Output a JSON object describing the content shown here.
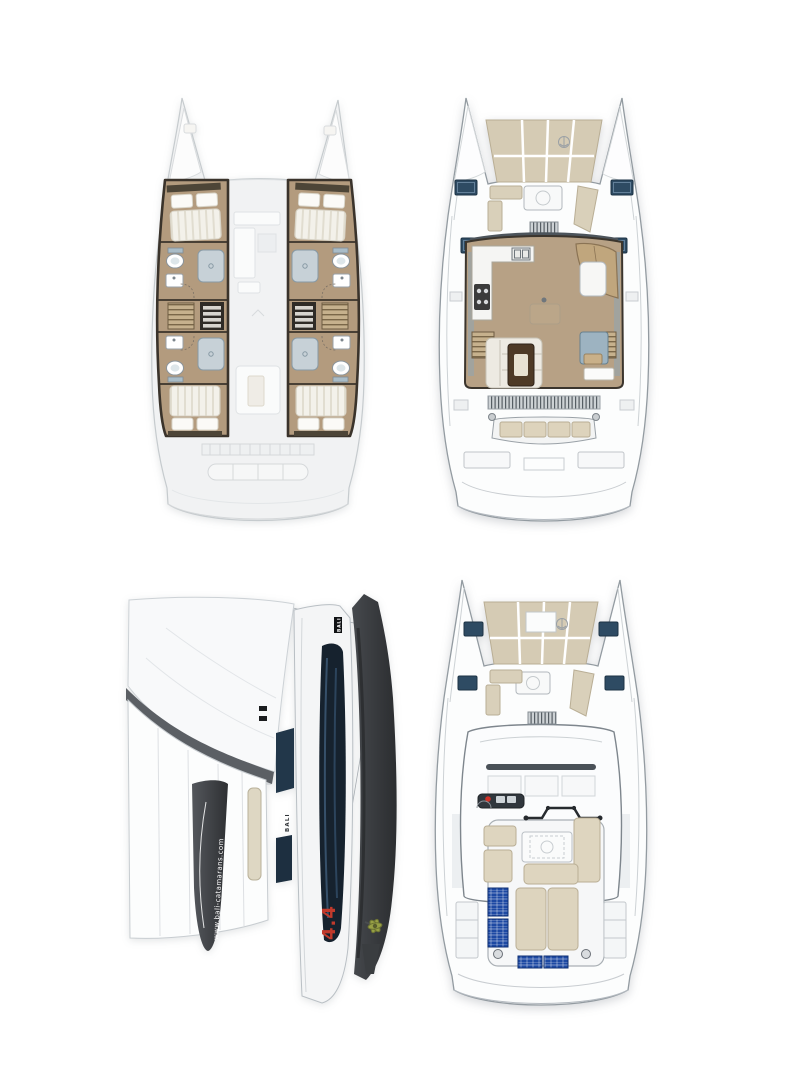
{
  "branding": {
    "brand": "BALI",
    "model": "4.4",
    "website": "www.bali-catamarans.com",
    "bow_chip_label": "BALI",
    "hull_side_label": "BALI"
  },
  "views": {
    "lower_deck_plan": {
      "position": "top-left",
      "cabins": 4,
      "bathrooms": 4
    },
    "main_deck_plan": {
      "position": "top-right",
      "deck_hatches": 4
    },
    "side_profile": {
      "position": "bottom-left"
    },
    "flybridge_plan": {
      "position": "bottom-right",
      "solar_panels": 4,
      "sunpads": 2,
      "deck_hatches": 4
    }
  },
  "colors": {
    "background": "#ffffff",
    "wood_floor": "#b39b7e",
    "interior_wall": "#3a332b",
    "cushion_beige": "#d9d0ba",
    "sunpad_beige": "#d5cbb4",
    "deck_hatch_blue": "#2e4b63",
    "solar_panel_blue": "#1d49a3",
    "fixture_blue_gray": "#9db3c1",
    "ghost_gray": "#f1f2f3",
    "hull_bottom_dark": "#3a3d41",
    "hull_window_navy": "#16222e",
    "model_number_red": "#c13a2c"
  }
}
